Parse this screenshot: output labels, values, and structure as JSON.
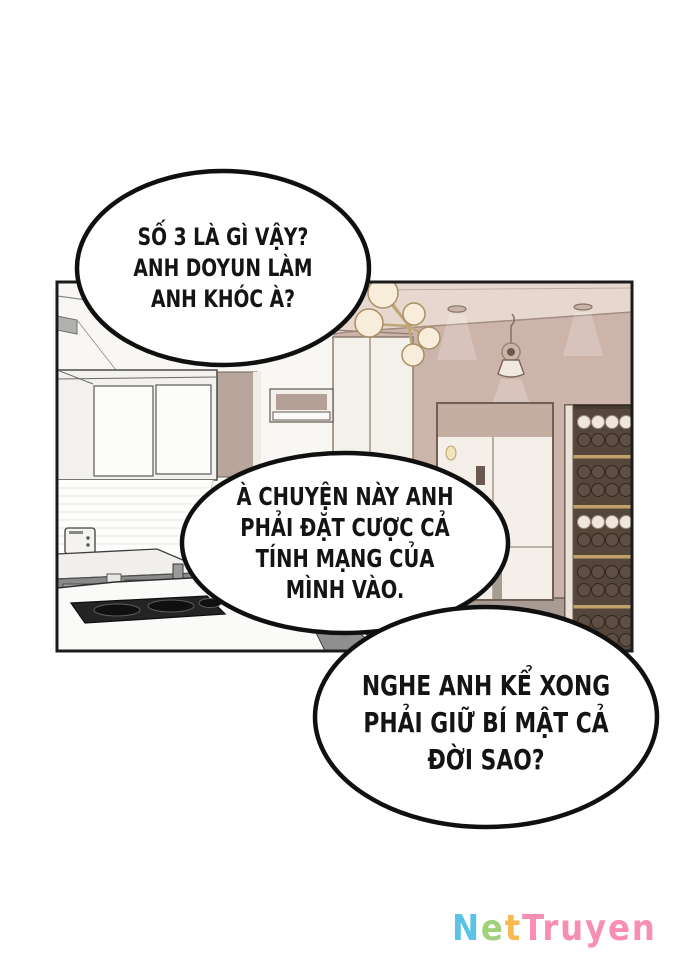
{
  "comic": {
    "bubbles": [
      {
        "lines": [
          "SỐ 3 LÀ GÌ VẬY?",
          "ANH DOYUN LÀM",
          "ANH KHÓC À?"
        ]
      },
      {
        "lines": [
          "À CHUYỆN NÀY ANH",
          "PHẢI ĐẶT CƯỢC CẢ",
          "TÍNH MẠNG CỦA",
          "MÌNH VÀO."
        ]
      },
      {
        "lines": [
          "NGHE ANH KỂ XONG",
          "PHẢI GIỮ BÍ MẬT CẢ",
          "ĐỜI SAO?"
        ]
      }
    ]
  },
  "watermark": {
    "text": "NetTruyen",
    "letters": [
      {
        "char": "N",
        "color": "#5bc3e8"
      },
      {
        "char": "e",
        "color": "#a1d17d"
      },
      {
        "char": "t",
        "color": "#f8b950"
      },
      {
        "char": "T",
        "color": "#f78fb5"
      },
      {
        "char": "r",
        "color": "#f78fb5"
      },
      {
        "char": "u",
        "color": "#f78fb5"
      },
      {
        "char": "y",
        "color": "#f78fb5"
      },
      {
        "char": "e",
        "color": "#f78fb5"
      },
      {
        "char": "n",
        "color": "#f78fb5"
      }
    ]
  },
  "panel": {
    "scene": "kitchen-interior",
    "colors": {
      "wall": "#cdb4ab",
      "ceiling": "#e7d8cf",
      "floor": "#a89b93",
      "cabinet_white": "#f4f1ea",
      "cabinet_taupe": "#b8a69c",
      "counter_gray": "#8a8a8a",
      "cooktop_black": "#242424",
      "rack_wood": "#453931",
      "rack_shelf": "#c2a06b",
      "bottle_cream": "#efe7dd",
      "bottle_dark": "#5f4e43",
      "globe": "#f7edda",
      "brass": "#c0a578",
      "door_panel": "#c6ada2",
      "outline": "#1b1b1b"
    }
  }
}
